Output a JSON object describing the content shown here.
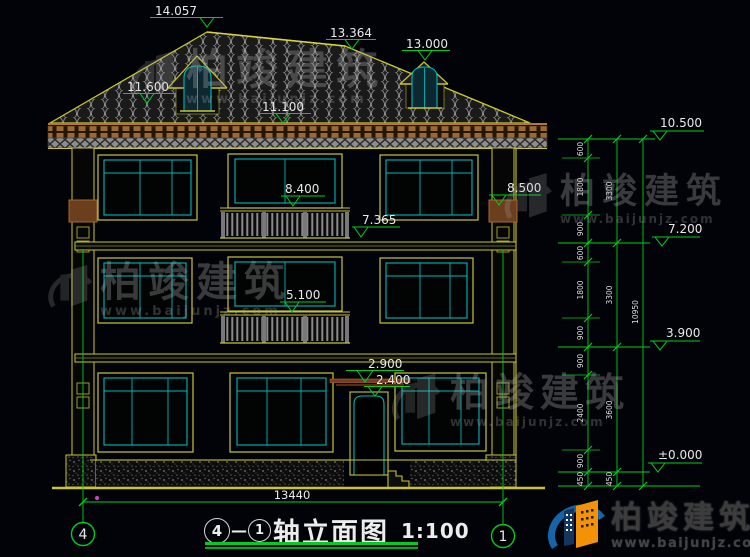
{
  "labels": {
    "l14057": "14.057",
    "l13364": "13.364",
    "l13000": "13.000",
    "l11600": "11.600",
    "l11100": "11.100",
    "l8400": "8.400",
    "l8500": "8.500",
    "l7365": "7.365",
    "l5100": "5.100",
    "l2900": "2.900",
    "l2400": "2.400",
    "l10500": "10.500",
    "l7200": "7.200",
    "l3900": "3.900",
    "l0000": "±0.000"
  },
  "dims": {
    "chain_inner": [
      "600",
      "1800",
      "900",
      "600",
      "1800",
      "900",
      "900",
      "2400",
      "900",
      "450"
    ],
    "chain_mid": [
      "3300",
      "3300",
      "3600",
      "450"
    ],
    "chain_total": "10950",
    "width_total": "13440"
  },
  "axes": {
    "left": "4",
    "right": "1"
  },
  "title": {
    "axis_from": "4",
    "separator": "—",
    "axis_to": "1",
    "name": "轴立面图",
    "scale": "1:100"
  },
  "watermark": {
    "brand": "柏竣建筑",
    "url": "www.baijunjz.com"
  },
  "footer_logo": {
    "brand": "柏竣建筑",
    "url": "www.baijunjz.com"
  },
  "colors": {
    "line_yellow": "#c9c52e",
    "line_green": "#00cc22",
    "line_cyan": "#00b7b7",
    "text_white": "#e9e9e9",
    "cornice_brown": "#9a6a30",
    "logo_blue": "#1665a8",
    "logo_orange": "#f39206"
  }
}
